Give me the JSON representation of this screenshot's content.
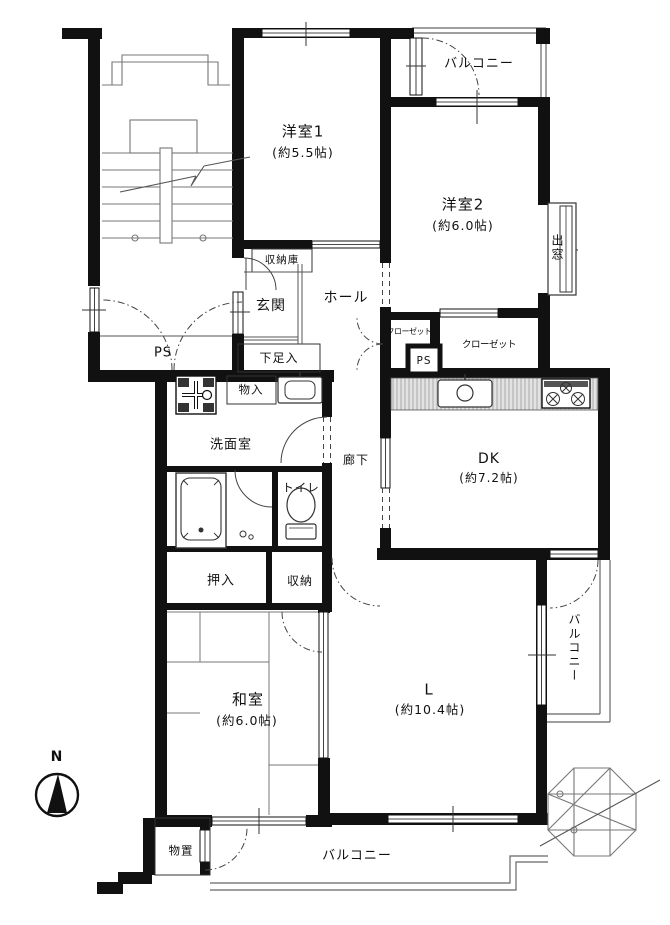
{
  "plan": {
    "title_hint": "apartment-floor-plan",
    "rooms": {
      "yoshitsu1": {
        "name": "洋室1",
        "size": "(約5.5帖)"
      },
      "yoshitsu2": {
        "name": "洋室2",
        "size": "(約6.0帖)"
      },
      "dk": {
        "name": "DK",
        "size": "(約7.2帖)"
      },
      "washitsu": {
        "name": "和室",
        "size": "(約6.0帖)"
      },
      "living": {
        "name": "L",
        "size": "(約10.4帖)"
      },
      "genkan": {
        "name": "玄関"
      },
      "hall": {
        "name": "ホール"
      },
      "roka": {
        "name": "廊下"
      },
      "senmenshitsu": {
        "name": "洗面室"
      },
      "toilet": {
        "name": "トイレ"
      }
    },
    "storage": {
      "shunoko": "収納庫",
      "geta": "下足入",
      "monoire": "物入",
      "oshiire": "押入",
      "shuno": "収納",
      "closet_left": "クローゼット",
      "closet_right": "クローゼット",
      "monooki": "物置"
    },
    "balconies": {
      "top": "バルコニー",
      "right": "バルコニー",
      "bottom": "バルコニー"
    },
    "features": {
      "demado": "出窓",
      "ps_main": "PS",
      "ps_small": "PS"
    },
    "compass": {
      "north": "N"
    },
    "colors": {
      "wall": "#111111",
      "line": "#444444",
      "counter": "#cccccc",
      "bg": "#ffffff"
    },
    "icons": [
      "staircase-icon",
      "spiral-staircase-icon",
      "compass-north-icon",
      "kitchen-sink-icon",
      "stove-burners-icon",
      "washing-machine-icon",
      "vanity-sink-icon",
      "bathtub-icon",
      "toilet-icon"
    ]
  }
}
